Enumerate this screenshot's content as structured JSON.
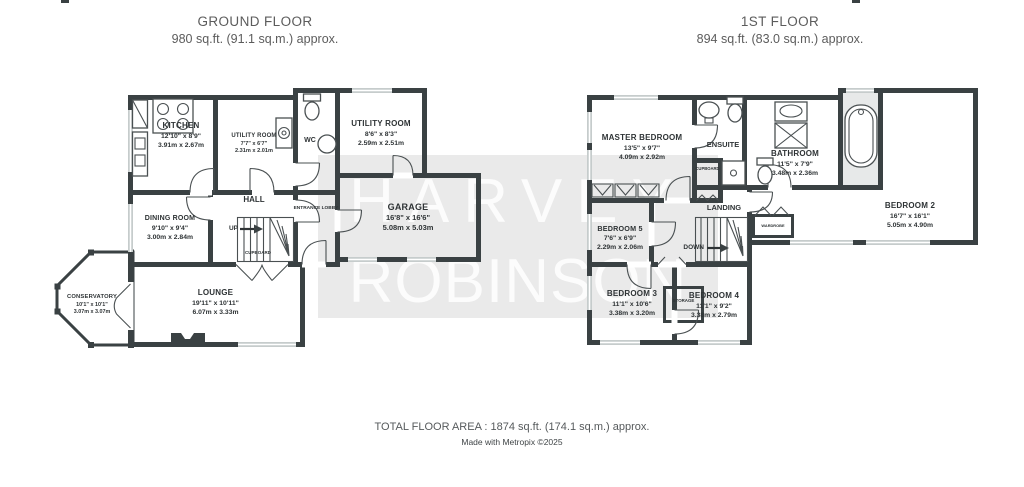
{
  "titles": {
    "ground_floor": {
      "name": "GROUND FLOOR",
      "area": "980 sq.ft. (91.1 sq.m.) approx."
    },
    "first_floor": {
      "name": "1ST FLOOR",
      "area": "894 sq.ft. (83.0 sq.m.) approx."
    }
  },
  "watermark": {
    "line1": "HARVEY",
    "line2": "ROBINSON"
  },
  "rooms": {
    "kitchen": {
      "name": "KITCHEN",
      "imperial": "12'10\" x 8'9\"",
      "metric": "3.91m x 2.67m"
    },
    "utility_room_1": {
      "name": "UTILITY ROOM",
      "imperial": "7'7\" x 6'7\"",
      "metric": "2.31m x 2.01m"
    },
    "utility_room_2": {
      "name": "UTILITY ROOM",
      "imperial": "8'6\" x 8'3\"",
      "metric": "2.59m x 2.51m"
    },
    "garage": {
      "name": "GARAGE",
      "imperial": "16'8\" x 16'6\"",
      "metric": "5.08m x 5.03m"
    },
    "dining_room": {
      "name": "DINING ROOM",
      "imperial": "9'10\" x 9'4\"",
      "metric": "3.00m x 2.84m"
    },
    "lounge": {
      "name": "LOUNGE",
      "imperial": "19'11\" x 10'11\"",
      "metric": "6.07m x 3.33m"
    },
    "conservatory": {
      "name": "CONSERVATORY",
      "imperial": "10'1\" x 10'1\"",
      "metric": "3.07m x 3.07m"
    },
    "master_bedroom": {
      "name": "MASTER BEDROOM",
      "imperial": "13'5\" x 9'7\"",
      "metric": "4.09m x 2.92m"
    },
    "bedroom_2": {
      "name": "BEDROOM 2",
      "imperial": "16'7\" x 16'1\"",
      "metric": "5.05m x 4.90m"
    },
    "bedroom_3": {
      "name": "BEDROOM 3",
      "imperial": "11'1\" x 10'6\"",
      "metric": "3.38m x 3.20m"
    },
    "bedroom_4": {
      "name": "BEDROOM 4",
      "imperial": "11'1\" x 9'2\"",
      "metric": "3.38m x 2.79m"
    },
    "bedroom_5": {
      "name": "BEDROOM 5",
      "imperial": "7'6\" x 6'9\"",
      "metric": "2.29m x 2.06m"
    },
    "bathroom": {
      "name": "BATHROOM",
      "imperial": "11'5\" x 7'9\"",
      "metric": "3.48m x 2.36m"
    }
  },
  "small_labels": {
    "hall": "HALL",
    "wc": "WC",
    "entrance_lobby": "ENTRANCE LOBBY",
    "ensuite": "ENSUITE",
    "landing": "LANDING",
    "cupboard_gf": "CUPBOARD",
    "cupboard_1f": "CUPBOARD",
    "storage": "STORAGE",
    "wardrobe": "WARDROBE",
    "up": "UP",
    "down": "DOWN"
  },
  "footer": {
    "total": "TOTAL FLOOR AREA : 1874 sq.ft. (174.1 sq.m.) approx.",
    "credit": "Made with Metropix ©2025"
  },
  "colors": {
    "wall": "#3a4143",
    "text": "#2e3335",
    "title": "#5c5c5c",
    "watermark_band": "#e9e9e9"
  }
}
